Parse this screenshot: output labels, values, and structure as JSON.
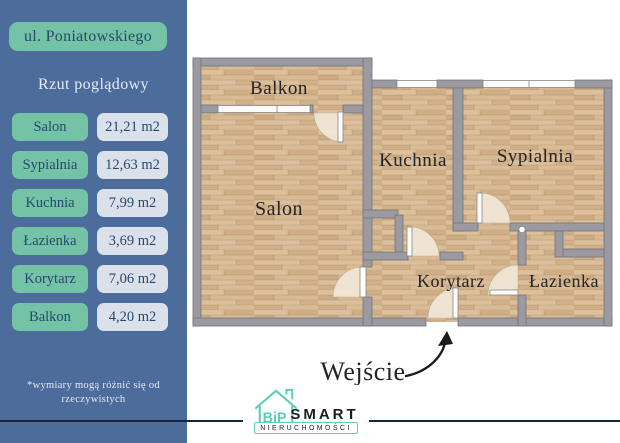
{
  "sidebar": {
    "address": "ul. Poniatowskiego",
    "subtitle": "Rzut poglądowy",
    "rooms": [
      {
        "name": "Salon",
        "area": "21,21 m2"
      },
      {
        "name": "Sypialnia",
        "area": "12,63 m2"
      },
      {
        "name": "Kuchnia",
        "area": "7,99 m2"
      },
      {
        "name": "Łazienka",
        "area": "3,69 m2"
      },
      {
        "name": "Korytarz",
        "area": "7,06 m2"
      },
      {
        "name": "Balkon",
        "area": "4,20 m2"
      }
    ],
    "disclaimer_line1": "*wymiary mogą różnić się od",
    "disclaimer_line2": "rzeczywistych"
  },
  "plan": {
    "labels": {
      "balkon": "Balkon",
      "salon": "Salon",
      "kuchnia": "Kuchnia",
      "sypialnia": "Sypialnia",
      "korytarz": "Korytarz",
      "lazienka": "Łazienka",
      "entrance": "Wejście"
    }
  },
  "footer": {
    "logo_mark": "BiP",
    "brand": "SMART",
    "brand_sub": "NIERUCHOMOŚCI"
  },
  "colors": {
    "sidebar_bg": "#4c6c9c",
    "accent_teal": "#75c3a6",
    "value_pill_bg": "#dbe1eb",
    "text_navy": "#27496f",
    "wall_gray": "#9a9aa0",
    "floor_wood": "#d5b58f",
    "logo_teal": "#5ccdb7"
  }
}
